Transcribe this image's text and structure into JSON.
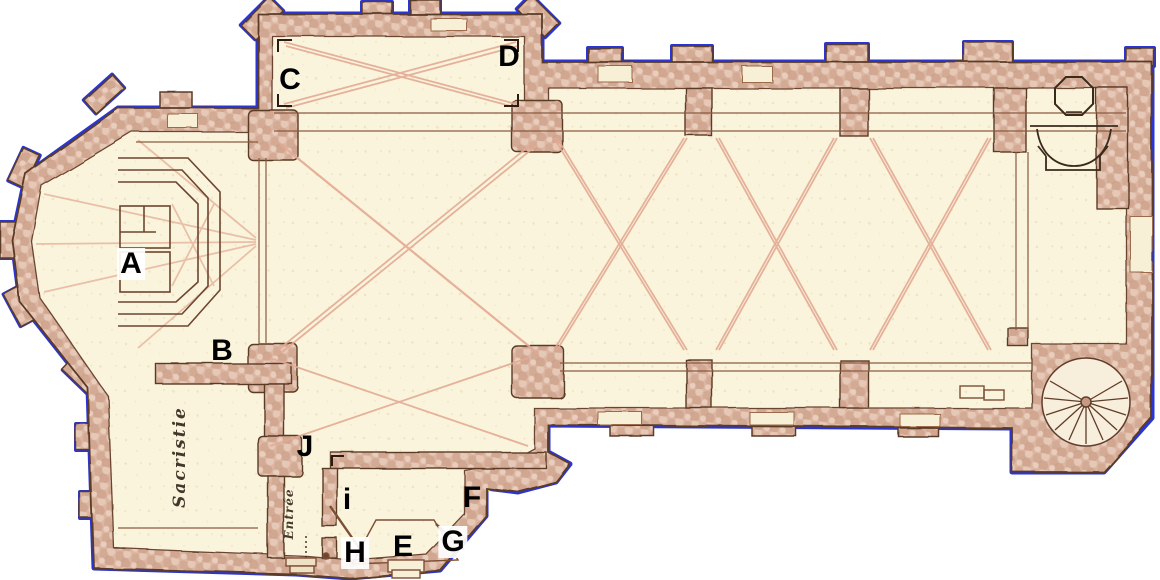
{
  "figure": {
    "kind": "scanned church floor plan",
    "orientation": "nave runs horizontally, apse at left, west front at right"
  },
  "palette": {
    "background": "#ffffff",
    "floor": "#faf4dd",
    "wall": "#d8b2a0",
    "wall_edge": "#5a3a28",
    "selection_outline_blue": "#2a35d2",
    "selection_outline_yellow": "#e8e23a",
    "vault_rib": "#e3aa94",
    "detail_line": "#8a5a40",
    "label_ink": "#000000"
  },
  "point_labels": [
    {
      "id": "A",
      "text": "A"
    },
    {
      "id": "B",
      "text": "B"
    },
    {
      "id": "C",
      "text": "C"
    },
    {
      "id": "D",
      "text": "D"
    },
    {
      "id": "E",
      "text": "E"
    },
    {
      "id": "F",
      "text": "F"
    },
    {
      "id": "G",
      "text": "G"
    },
    {
      "id": "H",
      "text": "H"
    },
    {
      "id": "i",
      "text": "i"
    },
    {
      "id": "J",
      "text": "J"
    }
  ],
  "room_labels": [
    {
      "id": "sacristie",
      "text": "Sacristie"
    },
    {
      "id": "entree",
      "text": "Entrée"
    }
  ]
}
